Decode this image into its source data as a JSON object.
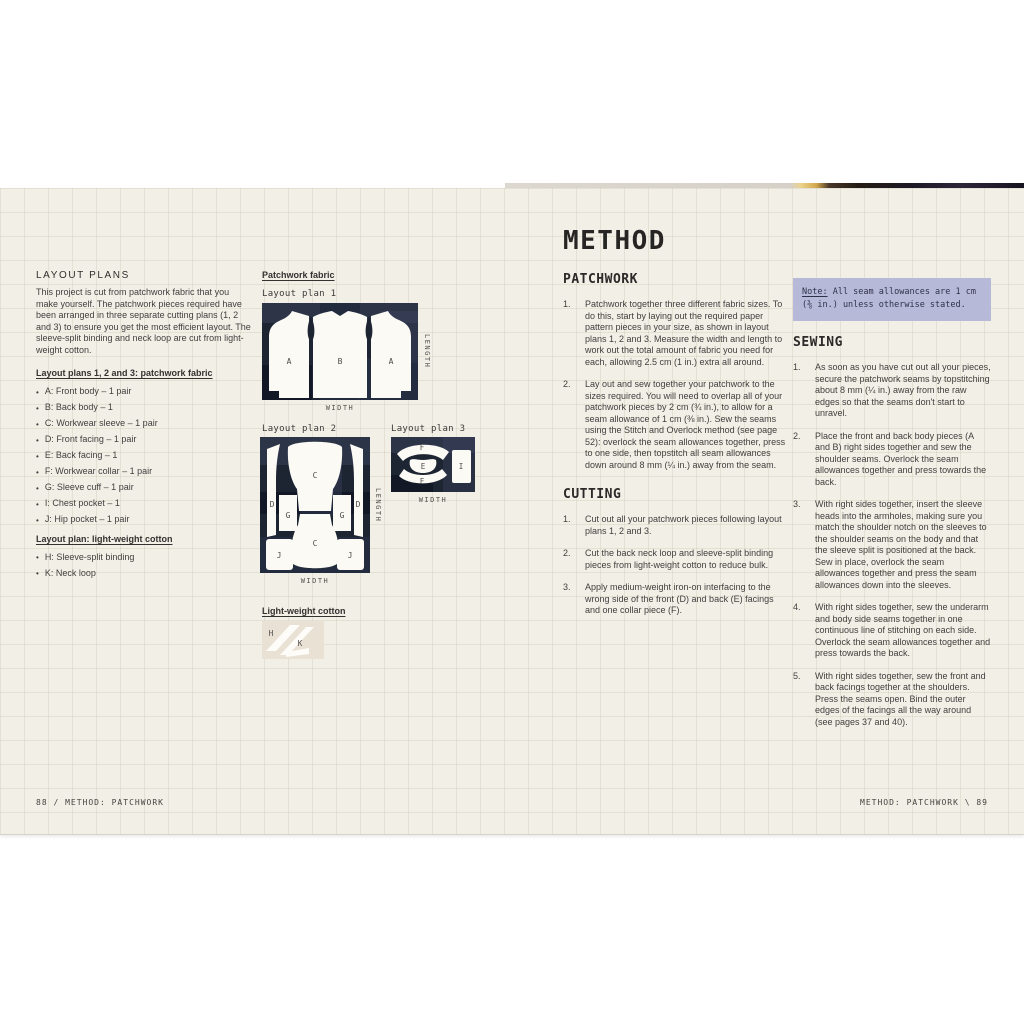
{
  "left_page": {
    "section_title": "LAYOUT PLANS",
    "intro": "This project is cut from patchwork fabric that you make yourself. The patchwork pieces required have been arranged in three separate cutting plans (1, 2 and 3) to ensure you get the most efficient layout. The sleeve-split binding and neck loop are cut from light-weight cotton.",
    "patchwork_list_heading": "Layout plans 1, 2 and 3: patchwork fabric",
    "patchwork_pieces": [
      "A: Front body – 1 pair",
      "B: Back body – 1",
      "C: Workwear sleeve – 1 pair",
      "D: Front facing – 1 pair",
      "E: Back facing – 1",
      "F: Workwear collar – 1 pair",
      "G: Sleeve cuff – 1 pair",
      "I: Chest pocket – 1",
      "J: Hip pocket – 1 pair"
    ],
    "lightweight_list_heading": "Layout plan: light-weight cotton",
    "lightweight_pieces": [
      "H: Sleeve-split binding",
      "K: Neck loop"
    ],
    "footer": "88 / METHOD: PATCHWORK"
  },
  "diagrams": {
    "column_heading": "Patchwork fabric",
    "lightweight_heading": "Light-weight cotton",
    "width_label": "WIDTH",
    "length_label": "LENGTH",
    "plan1": {
      "label": "Layout plan 1",
      "labels": {
        "a_left": "A",
        "b_center": "B",
        "a_right": "A"
      }
    },
    "plan2": {
      "label": "Layout plan 2",
      "labels": {
        "d_left": "D",
        "c_top": "C",
        "d_right": "D",
        "g_left": "G",
        "g_right": "G",
        "j_left": "J",
        "c_bottom": "C",
        "j_right": "J"
      }
    },
    "plan3": {
      "label": "Layout plan 3",
      "labels": {
        "f_top": "F",
        "e_center": "E",
        "f_bottom": "F",
        "i_right": "I"
      }
    },
    "swatch": {
      "labels": {
        "h": "H",
        "k": "K"
      }
    }
  },
  "right_page": {
    "title": "METHOD",
    "patchwork": {
      "heading": "PATCHWORK",
      "steps": [
        {
          "num": "1.",
          "text": "Patchwork together three different fabric sizes. To do this, start by laying out the required paper pattern pieces in your size, as shown in layout plans 1, 2 and 3. Measure the width and length to work out the total amount of fabric you need for each, allowing 2.5 cm (1 in.) extra all around."
        },
        {
          "num": "2.",
          "text": "Lay out and sew together your patchwork to the sizes required. You will need to overlap all of your patchwork pieces by 2 cm (¾ in.), to allow for a seam allowance of 1 cm (⅜ in.). Sew the seams using the Stitch and Overlock method (see page 52): overlock the seam allowances together, press to one side, then topstitch all seam allowances down around 8 mm (¼ in.) away from the seam."
        }
      ]
    },
    "cutting": {
      "heading": "CUTTING",
      "steps": [
        {
          "num": "1.",
          "text": "Cut out all your patchwork pieces following layout plans 1, 2 and 3."
        },
        {
          "num": "2.",
          "text": "Cut the back neck loop and sleeve-split binding pieces from light-weight cotton to reduce bulk."
        },
        {
          "num": "3.",
          "text": "Apply medium-weight iron-on interfacing to the wrong side of the front (D) and back (E) facings and one collar piece (F)."
        }
      ]
    },
    "note": {
      "label": "Note:",
      "text": " All seam allowances are 1 cm (⅜ in.) unless otherwise stated."
    },
    "sewing": {
      "heading": "SEWING",
      "steps": [
        {
          "num": "1.",
          "text": "As soon as you have cut out all your pieces, secure the patchwork seams by topstitching about 8 mm (¼ in.) away from the raw edges so that the seams don't start to unravel."
        },
        {
          "num": "2.",
          "text": "Place the front and back body pieces (A and B) right sides together and sew the shoulder seams. Overlock the seam allowances together and press towards the back."
        },
        {
          "num": "3.",
          "text": "With right sides together, insert the sleeve heads into the armholes, making sure you match the shoulder notch on the sleeves to the shoulder seams on the body and that the sleeve split is positioned at the back. Sew in place, overlock the seam allowances together and press the seam allowances down into the sleeves."
        },
        {
          "num": "4.",
          "text": "With right sides together, sew the underarm and body side seams together in one continuous line of stitching on each side. Overlock the seam allowances together and press towards the back."
        },
        {
          "num": "5.",
          "text": "With right sides together, sew the front and back facings together at the shoulders. Press the seams open. Bind the outer edges of the facings all the way around (see pages 37 and 40)."
        }
      ]
    },
    "footer": "METHOD: PATCHWORK \\ 89"
  },
  "colors": {
    "page_cream": "#f2efe7",
    "fabric_navy": "#1d2432",
    "note_lavender": "#b7b9d8",
    "swatch_beige": "#e9e1d4"
  }
}
